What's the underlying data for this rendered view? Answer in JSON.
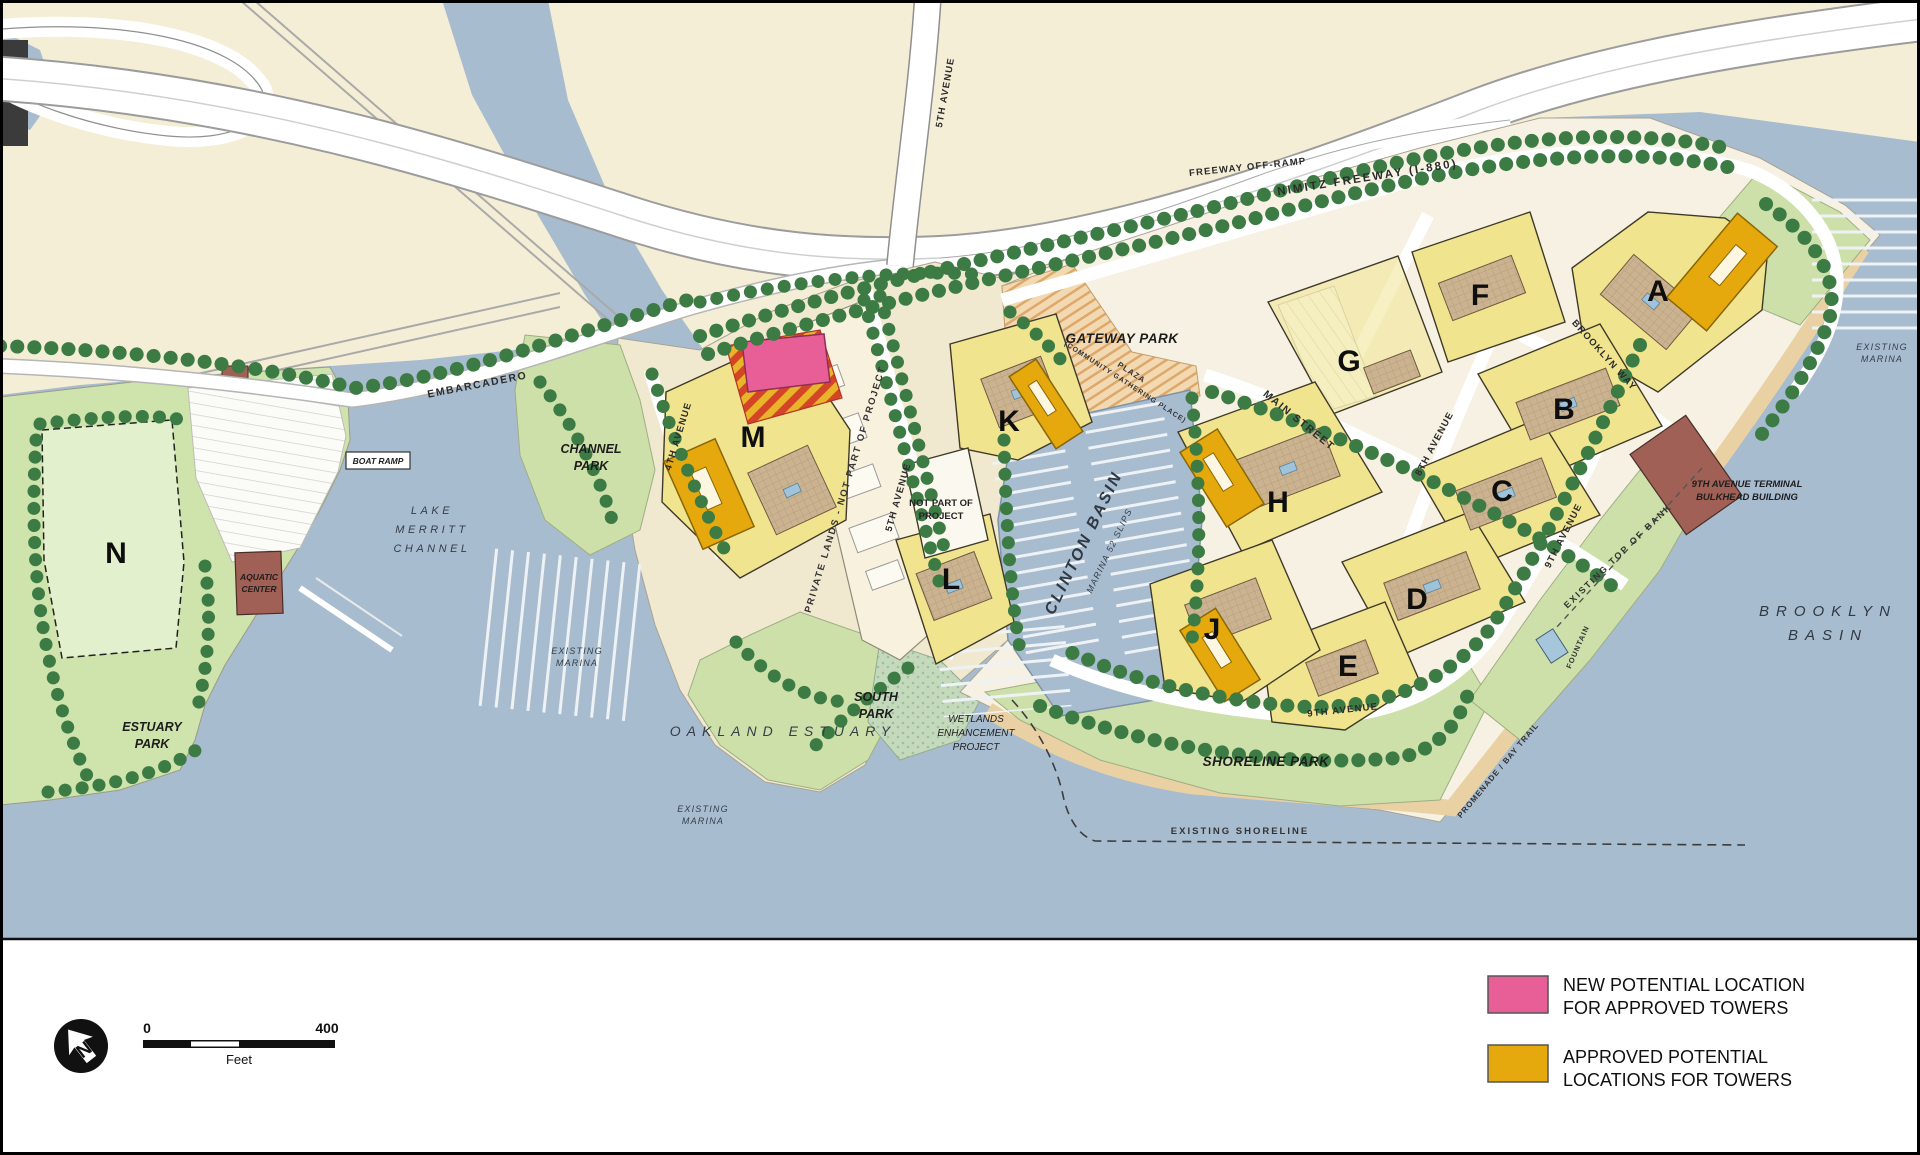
{
  "legend": {
    "items": [
      {
        "color": "#e85f98",
        "line1": "NEW POTENTIAL LOCATION",
        "line2": "FOR APPROVED TOWERS"
      },
      {
        "color": "#e5a90e",
        "line1": "APPROVED POTENTIAL",
        "line2": "LOCATIONS FOR TOWERS"
      }
    ]
  },
  "scale_bar": {
    "zero": "0",
    "max": "400",
    "unit": "Feet"
  },
  "north_arrow": {
    "letter": "N"
  },
  "parcels": [
    {
      "letter": "A"
    },
    {
      "letter": "B"
    },
    {
      "letter": "C"
    },
    {
      "letter": "D"
    },
    {
      "letter": "E"
    },
    {
      "letter": "F"
    },
    {
      "letter": "G"
    },
    {
      "letter": "H"
    },
    {
      "letter": "J"
    },
    {
      "letter": "K"
    },
    {
      "letter": "L"
    },
    {
      "letter": "M"
    },
    {
      "letter": "N"
    }
  ],
  "roads": [
    {
      "name": "5TH AVENUE"
    },
    {
      "name": "FREEWAY OFF-RAMP"
    },
    {
      "name": "NIMITZ FREEWAY (I-880)"
    },
    {
      "name": "EMBARCADERO"
    },
    {
      "name": "4TH AVENUE"
    },
    {
      "name": "5TH AVENUE"
    },
    {
      "name": "MAIN STREET"
    },
    {
      "name": "BROOKLYN WAY"
    },
    {
      "name": "8TH AVENUE"
    },
    {
      "name": "9TH AVENUE"
    },
    {
      "name": "9TH AVENUE"
    }
  ],
  "water_labels": {
    "lake_merritt": [
      "LAKE",
      "MERRITT",
      "CHANNEL"
    ],
    "clinton_basin": "CLINTON BASIN",
    "clinton_marina": "MARINA 52 SLIPS",
    "brooklyn_basin": [
      "BROOKLYN",
      "BASIN"
    ],
    "oakland_estuary": "OAKLAND ESTUARY",
    "existing_marina": [
      "EXISTING",
      "MARINA"
    ],
    "existing_shoreline": "EXISTING SHORELINE"
  },
  "features": {
    "gateway_park": "GATEWAY PARK",
    "plaza": [
      "PLAZA",
      "(COMMUNITY GATHERING PLACE)"
    ],
    "channel_park": [
      "CHANNEL",
      "PARK"
    ],
    "estuary_park": [
      "ESTUARY",
      "PARK"
    ],
    "south_park": [
      "SOUTH",
      "PARK"
    ],
    "shoreline_park": "SHORELINE PARK",
    "wetlands": [
      "WETLANDS",
      "ENHANCEMENT",
      "PROJECT"
    ],
    "aquatic_center": [
      "AQUATIC",
      "CENTER"
    ],
    "boat_ramp": "BOAT RAMP",
    "terminal": [
      "9TH AVENUE TERMINAL",
      "BULKHEAD BUILDING"
    ],
    "top_of_bank": "EXISTING TOP OF BANK",
    "promenade": "PROMENADE / BAY TRAIL",
    "fountain": "FOUNTAIN",
    "not_part_of_project": [
      "NOT PART OF",
      "PROJECT"
    ],
    "private_lands": "PRIVATE LANDS - NOT PART OF PROJECT"
  },
  "colors": {
    "water": "#a8bccf",
    "land_cream": "#f5eed6",
    "park_green": "#cde0a9",
    "parcel_yellow": "#f1e48f",
    "tower_gold": "#e5a90e",
    "new_tower_pink": "#e85f98",
    "building_brown": "#a06055",
    "tree_green": "#3d7b45"
  }
}
